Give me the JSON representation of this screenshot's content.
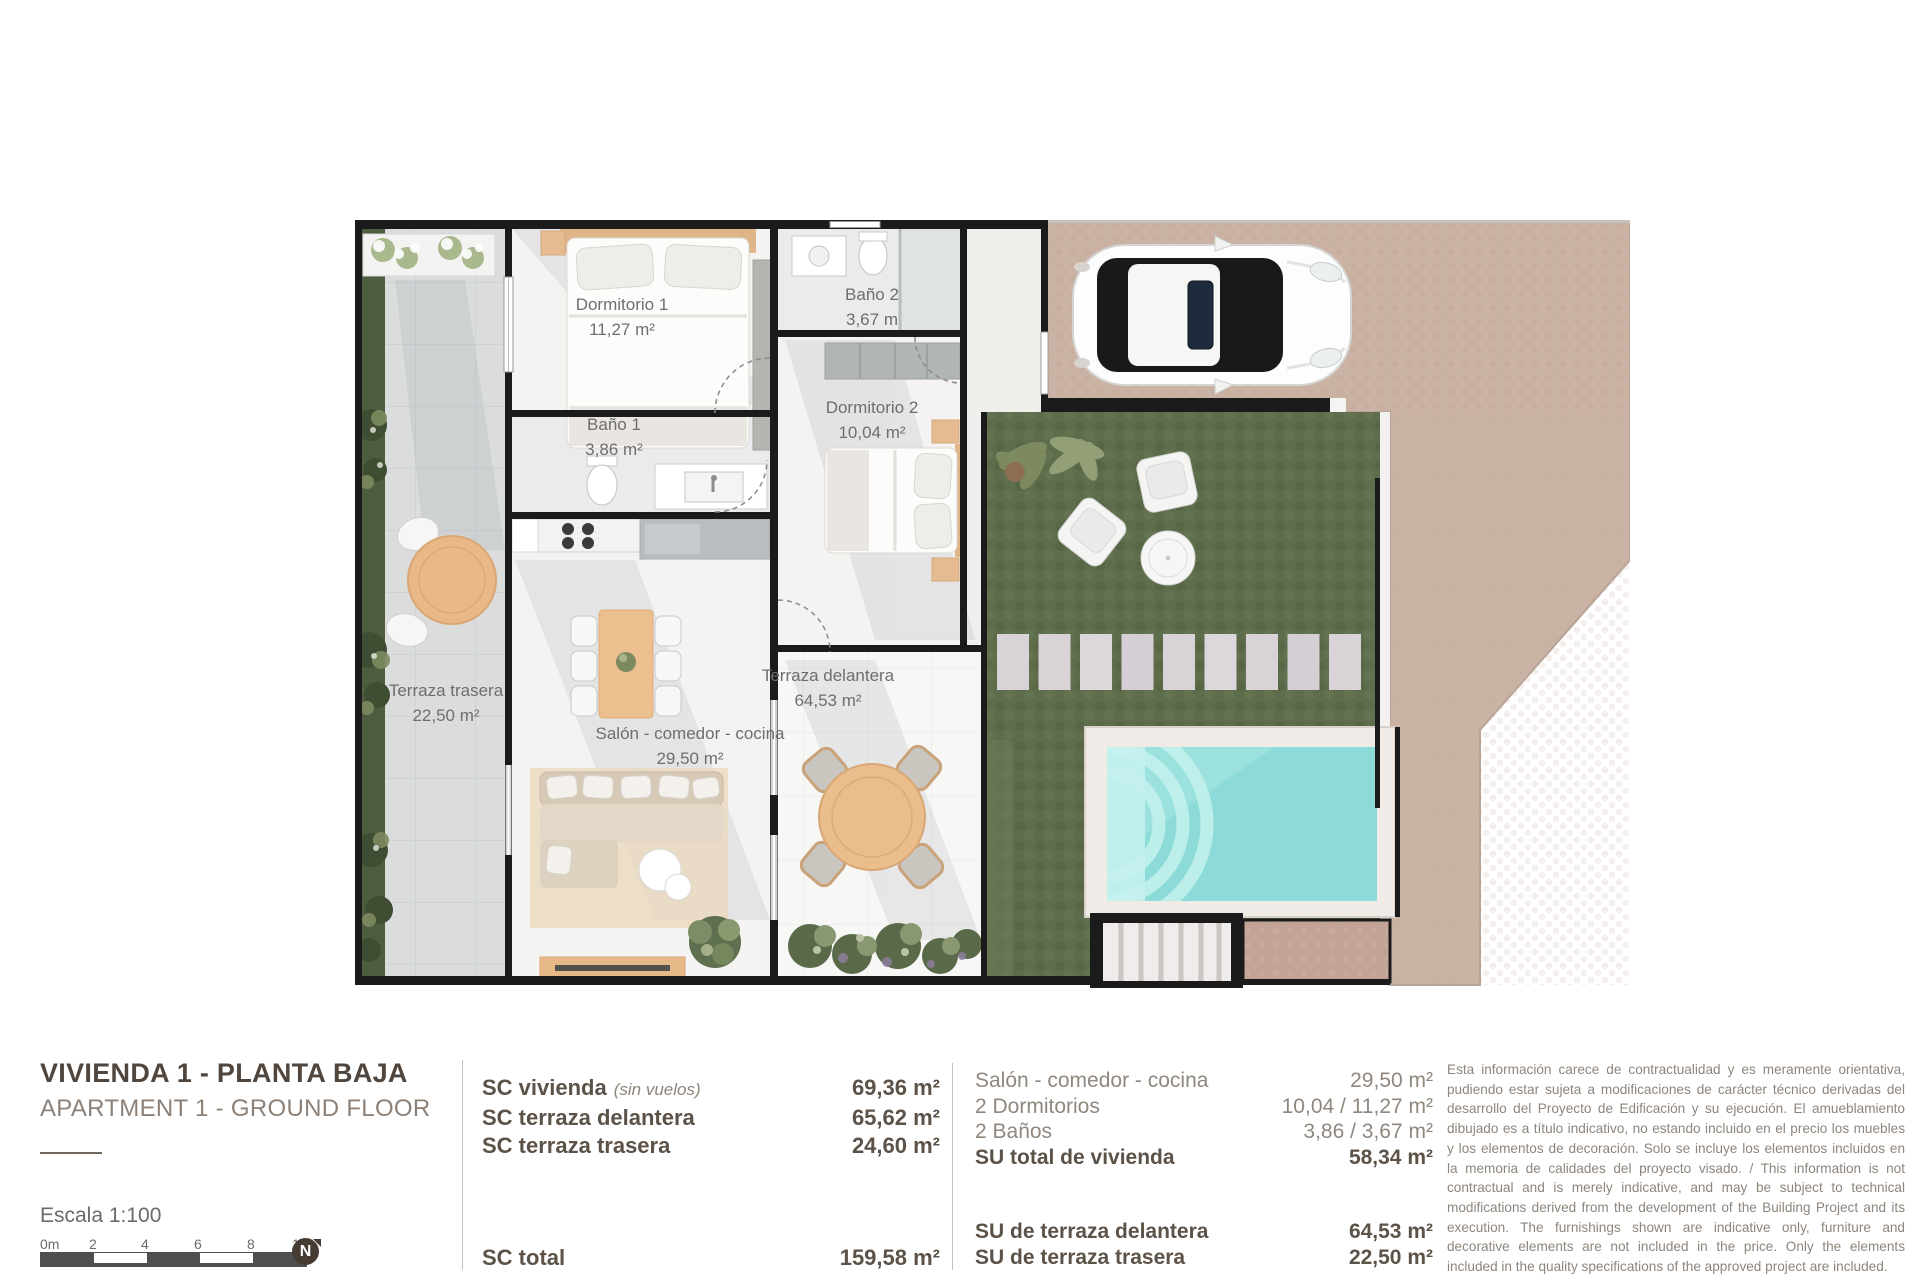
{
  "palette": {
    "wall": "#1b1b1b",
    "lawn": "#5e6d4c",
    "pool": "#8ddbd8",
    "pool_steps": "#c4f1ed",
    "paving": "#cab3a5",
    "cobble": "#c3a395",
    "tiles": "#dbdddd",
    "wood": "#e8b887",
    "text_dark": "#51463d",
    "text_light": "#8d8177",
    "label_gray": "#6e6e6e"
  },
  "plan": {
    "rooms": [
      {
        "name": "Dormitorio 1",
        "area": "11,27 m²"
      },
      {
        "name": "Baño 2",
        "area": "3,67 m"
      },
      {
        "name": "Baño 1",
        "area": "3,86 m²"
      },
      {
        "name": "Dormitorio 2",
        "area": "10,04 m²"
      },
      {
        "name": "Terraza trasera",
        "area": "22,50 m²"
      },
      {
        "name": "Salón - comedor - cocina",
        "area": "29,50 m²"
      },
      {
        "name": "Terraza delantera",
        "area": "64,53 m²"
      }
    ]
  },
  "title_block": {
    "title": "VIVIENDA 1 - PLANTA BAJA",
    "subtitle": "APARTMENT 1 - GROUND FLOOR",
    "scale_label": "Escala  1:100",
    "scale_ticks": [
      "0m",
      "2",
      "4",
      "6",
      "8",
      "10"
    ],
    "north_letter": "N"
  },
  "sc_table": {
    "rows": [
      {
        "label": "SC vivienda",
        "note": "(sin vuelos)",
        "value": "69,36 m²"
      },
      {
        "label": "SC terraza delantera",
        "note": "",
        "value": "65,62 m²"
      },
      {
        "label": "SC terraza trasera",
        "note": "",
        "value": "24,60 m²"
      }
    ],
    "total": {
      "label": "SC total",
      "value": "159,58 m²"
    }
  },
  "su_table": {
    "rows": [
      {
        "label": "Salón - comedor - cocina",
        "value": "29,50 m²"
      },
      {
        "label": "2 Dormitorios",
        "value": "10,04 / 11,27 m²"
      },
      {
        "label": "2 Baños",
        "value": "3,86 / 3,67 m²"
      },
      {
        "label": "SU total de vivienda",
        "value": "58,34 m²"
      }
    ],
    "terrace_rows": [
      {
        "label": "SU de terraza delantera",
        "value": "64,53 m²"
      },
      {
        "label": "SU de terraza trasera",
        "value": "22,50 m²"
      }
    ]
  },
  "disclaimer": "Esta información carece de contractualidad y es meramente orientativa, pudiendo estar sujeta a modificaciones de carácter técnico derivadas del desarrollo del Proyecto de Edificación y su ejecución. El amueblamiento dibujado es a título indicativo, no estando incluido en el precio los muebles y los elementos de decoración. Solo se incluye los elementos incluidos en la memoria de calidades del proyecto visado. / This information is not contractual and is merely indicative, and may be subject to technical modifications derived from the development of the Building Project and its execution. The furnishings shown are indicative only, furniture and decorative elements are not included in the price. Only the elements included in the quality specifications of the approved project are included."
}
